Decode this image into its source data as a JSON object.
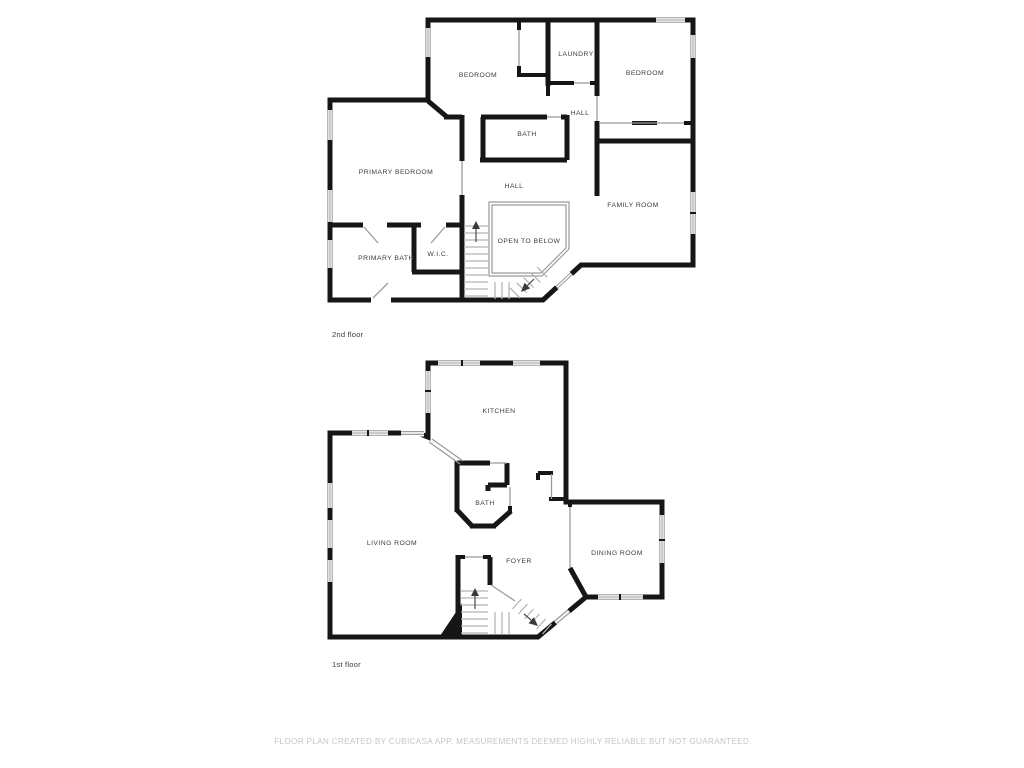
{
  "floor2": {
    "floor_label": "2nd floor",
    "rooms": {
      "bedroom_left": "BEDROOM",
      "laundry": "LAUNDRY",
      "bedroom_right": "BEDROOM",
      "hall_upper": "HALL",
      "bath": "BATH",
      "primary_bedroom": "PRIMARY BEDROOM",
      "hall": "HALL",
      "family_room": "FAMILY ROOM",
      "open_to_below": "OPEN TO BELOW",
      "primary_bath": "PRIMARY BATH",
      "wic": "W.I.C."
    }
  },
  "floor1": {
    "floor_label": "1st floor",
    "rooms": {
      "kitchen": "KITCHEN",
      "bath": "BATH",
      "living_room": "LIVING ROOM",
      "foyer": "FOYER",
      "dining_room": "DINING ROOM"
    }
  },
  "footer": {
    "disclaimer": "FLOOR PLAN CREATED BY CUBICASA APP. MEASUREMENTS DEEMED HIGHLY RELIABLE BUT NOT GUARANTEED."
  },
  "colors": {
    "wall": "#161616",
    "door_line": "#9b9b9b",
    "stair_tread": "#b5b5b5",
    "room_label": "#3c3c3c",
    "floor_label": "#3b3b3b",
    "footer_text": "#c6c6c6"
  }
}
